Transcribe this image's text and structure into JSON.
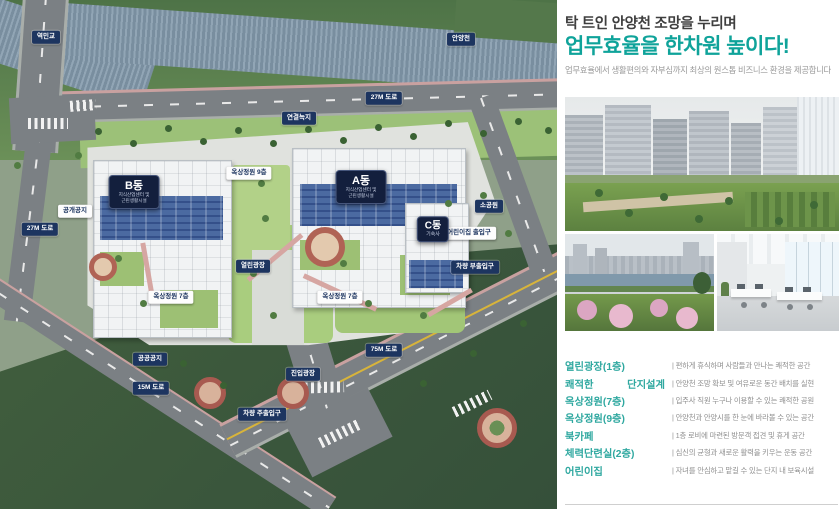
{
  "map": {
    "badges": [
      {
        "label": "역민교"
      },
      {
        "label": "안양천"
      },
      {
        "label": "27M 도로"
      },
      {
        "label": "연결녹지"
      },
      {
        "label": "옥상정원 9층"
      },
      {
        "label": "공개공지"
      },
      {
        "label": "소공원"
      },
      {
        "label": "어린이집 출입구"
      },
      {
        "label": "차량 부출입구"
      },
      {
        "label": "열린광장"
      },
      {
        "label": "옥상정원 7층"
      },
      {
        "label": "옥상정원 7층"
      },
      {
        "label": "공공공지"
      },
      {
        "label": "15M 도로"
      },
      {
        "label": "진입광장"
      },
      {
        "label": "75M 도로"
      },
      {
        "label": "차량 주출입구"
      },
      {
        "label": "27M 도로"
      }
    ],
    "buildings": {
      "a": {
        "name": "A동",
        "sub1": "지식산업센터 및",
        "sub2": "근린생활시설"
      },
      "b": {
        "name": "B동",
        "sub1": "지식산업센터 및",
        "sub2": "근린생활시설"
      },
      "c": {
        "name": "C동",
        "sub1": "기숙사"
      }
    }
  },
  "panel": {
    "title_line1": "탁 트인 안양천 조망을 누리며",
    "title_line2": "업무효율을 한차원 높이다!",
    "subtitle": "업무효율에서 생활편의와 자부심까지 최상의 원스톱 비즈니스 환경을 제공합니다",
    "features": [
      {
        "label": "열린광장(1층)",
        "desc": "| 편하게 휴식하며 사람들과 만나는 쾌적한 공간"
      },
      {
        "label": "쾌적한 단지설계",
        "desc": "| 안양천 조망 확보 및 여유로운 동간 배치를 실현"
      },
      {
        "label": "옥상정원(7층)",
        "desc": "| 입주사 직원 누구나 이용할 수 있는 쾌적한 공원"
      },
      {
        "label": "옥상정원(9층)",
        "desc": "| 안양천과 안양시를 한 눈에 바라볼 수 있는 공간"
      },
      {
        "label": "북카페",
        "desc": "| 1층 로비에 마련된 방문객 접견 및 휴게 공간"
      },
      {
        "label": "체력단련실(2층)",
        "desc": "| 심신의 균형과 새로운 활력을 키우는 운동 공간"
      },
      {
        "label": "어린이집",
        "desc": "| 자녀를 안심하고 맡길 수 있는 단지 내 보육시설"
      }
    ]
  },
  "colors": {
    "accent_teal": "#0fa39a",
    "badge_navy": "#1d3560",
    "field_green": "#3f5d3c",
    "river_blue": "#8299ab"
  }
}
